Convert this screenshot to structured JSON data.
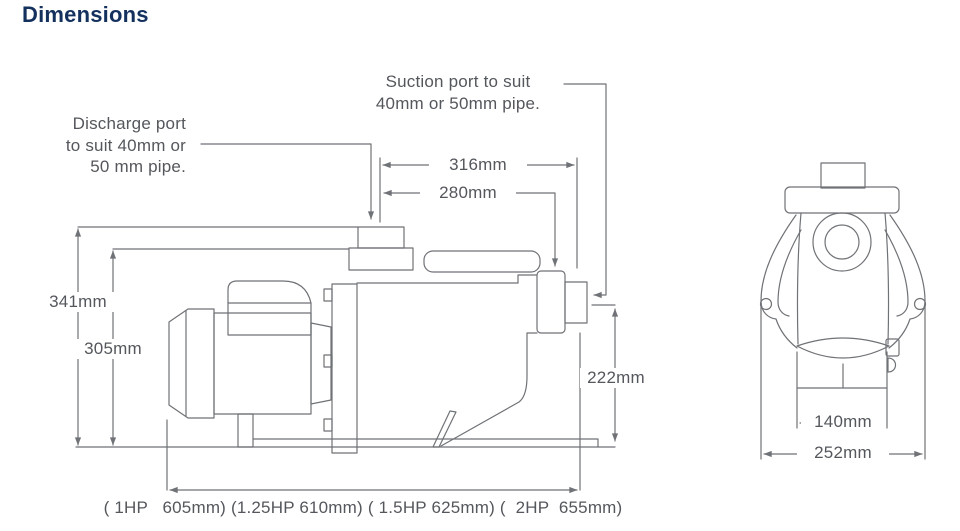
{
  "title": "Dimensions",
  "colors": {
    "title": "#14315e",
    "line": "#6f7276",
    "text": "#54575c"
  },
  "side_view": {
    "suction_label": "Suction port to suit\n40mm or 50mm pipe.",
    "discharge_label": "Discharge port\nto suit 40mm or\n50 mm pipe.",
    "dim_width_overall": "316mm",
    "dim_width_to_port": "280mm",
    "dim_height_overall": "341mm",
    "dim_height_body": "305mm",
    "dim_port_height": "222mm",
    "length_by_hp": "( 1HP   605mm) (1.25HP 610mm) ( 1.5HP 625mm) (  2HP  655mm)"
  },
  "front_view": {
    "dim_base_width": "140mm",
    "dim_overall_width": "252mm"
  }
}
